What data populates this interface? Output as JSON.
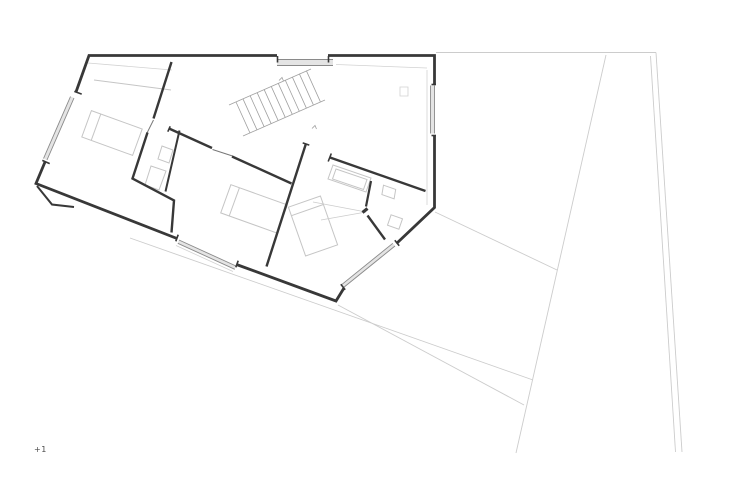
{
  "drawing": {
    "floor_label": "+1",
    "colors": {
      "background": "#ffffff",
      "wall": "#383838",
      "window_line": "#8a8a8a",
      "glazing_fill": "#e4e4e4",
      "stair_line": "#a0a0a0",
      "furniture_line": "#c5c5c5",
      "site_line": "#cccccc",
      "inner_face_line": "#d2d2d2",
      "door_line": "#777777",
      "label_text": "#4a4a4a"
    },
    "features": [
      "exterior-walls",
      "interior-walls",
      "windows",
      "staircase",
      "doors",
      "bathtub",
      "sink",
      "toilet",
      "beds",
      "wardrobe",
      "site-boundary-lines",
      "terrain-lines"
    ]
  }
}
